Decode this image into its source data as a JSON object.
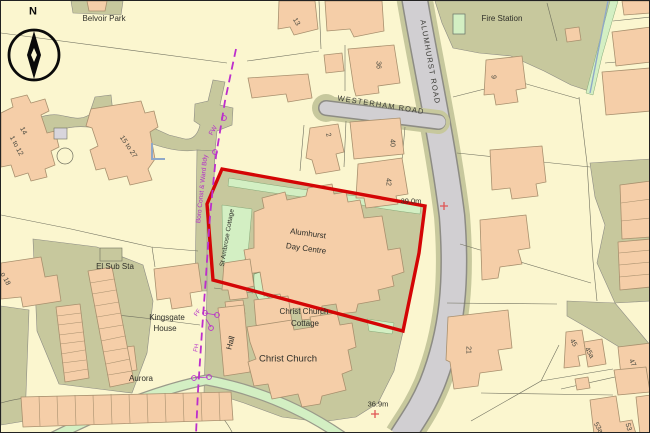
{
  "colors": {
    "background": "#FBF6CF",
    "land_olive": "#C7C89D",
    "road_gray": "#D1CFD2",
    "building_peach": "#F5CEA8",
    "vegetation_green": "#D3EFC3",
    "site_boundary_red": "#D40505",
    "admin_boundary_purple": "#BC2ECC"
  },
  "compass": {
    "north": "N"
  },
  "roads": {
    "westerham": "WESTERHAM ROAD",
    "alumhurst": "ALUMHURST ROAD"
  },
  "places": {
    "belvoir_park": "Belvoir Park",
    "fire_station": "Fire Station",
    "day_centre_line1": "Alumhurst",
    "day_centre_line2": "Day Centre",
    "christ_church_cottage_line1": "Christ Church",
    "christ_church_cottage_line2": "Cottage",
    "christ_church": "Christ Church",
    "hall": "Hall",
    "el_sub_sta": "El Sub Sta",
    "kingsgate_line1": "Kingsgate",
    "kingsgate_line2": "House",
    "aurora": "Aurora",
    "st_ambrose_cottage": "St Ambrose Cottage"
  },
  "spot_heights": {
    "north": "39.0m",
    "south": "36.9m"
  },
  "boundary": {
    "boro_const_ward_bdy": "Boro Const & Ward Bdy",
    "fw": "FW",
    "ff": "FF",
    "fh": "FH"
  },
  "house_numbers": {
    "n13": "13",
    "n36": "36",
    "n2": "2",
    "n40": "40",
    "n42": "42",
    "n9": "9",
    "n21": "21",
    "n45": "45",
    "n45a": "45a",
    "n47": "47",
    "n53a": "53a",
    "n53": "53",
    "flats_1_12": "1 to 12",
    "n14": "14",
    "flats_15_27": "15 to 27",
    "n18_partial": "o 18"
  }
}
